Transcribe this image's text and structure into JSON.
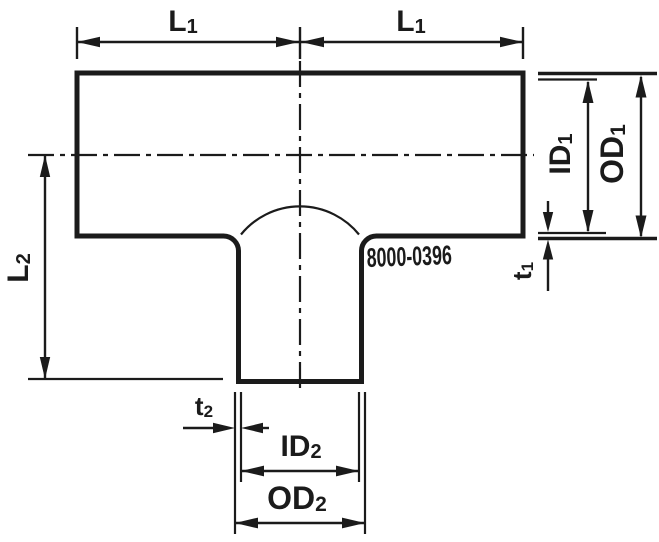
{
  "background": "#ffffff",
  "line_color": "#1b1b1b",
  "part_number": "8000-0396",
  "labels": {
    "l1_left": {
      "base": "L",
      "sub": "1"
    },
    "l1_right": {
      "base": "L",
      "sub": "1"
    },
    "l2": {
      "base": "L",
      "sub": "2"
    },
    "id1": {
      "base": "ID",
      "sub": "1"
    },
    "od1": {
      "base": "OD",
      "sub": "1"
    },
    "t1": {
      "base": "t",
      "sub": "1"
    },
    "t2": {
      "base": "t",
      "sub": "2"
    },
    "id2": {
      "base": "ID",
      "sub": "2"
    },
    "od2": {
      "base": "OD",
      "sub": "2"
    }
  }
}
